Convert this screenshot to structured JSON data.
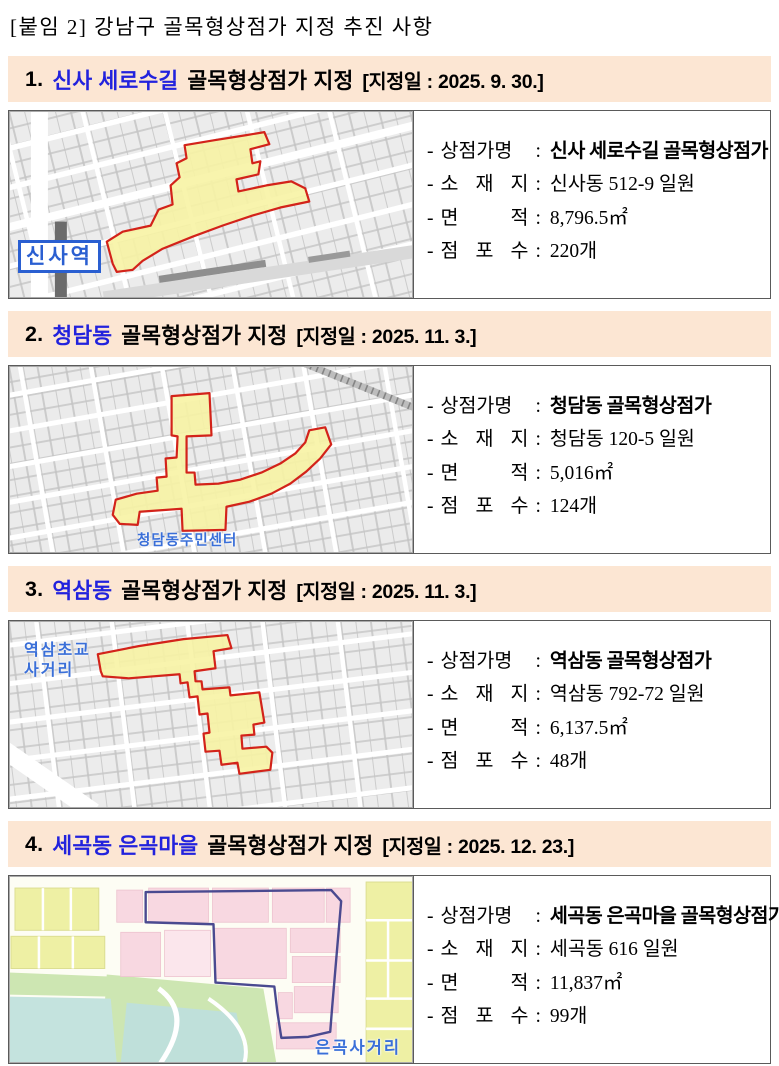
{
  "ui": {
    "dash": "-",
    "colon": ":"
  },
  "page": {
    "title": "[붙임 2] 강남구 골목형상점가 지정 추진 사항"
  },
  "colors": {
    "header_bg": "#fce6d3",
    "header_accent": "#2222dd",
    "highlight_fill": "#f7f3a4",
    "highlight_stroke": "#d3231a",
    "district_outline": "#4a4a90",
    "map_label_blue": "#2a5fd1"
  },
  "sections": [
    {
      "number": "1.",
      "name": "신사 세로수길",
      "title_rest": "골목형상점가 지정",
      "date": "[지정일 : 2025. 9. 30.]",
      "map_label": "신사역",
      "fields": [
        {
          "label": "상점가명",
          "value": "신사 세로수길 골목형상점가"
        },
        {
          "label": "소 재 지",
          "value": "신사동 512-9 일원"
        },
        {
          "label": "면 적",
          "value": "8,796.5㎡"
        },
        {
          "label": "점 포 수",
          "value": "220개"
        }
      ]
    },
    {
      "number": "2.",
      "name": "청담동",
      "title_rest": "골목형상점가 지정",
      "date": "[지정일 : 2025. 11. 3.]",
      "map_label": "청담동주민센터",
      "fields": [
        {
          "label": "상점가명",
          "value": "청담동 골목형상점가"
        },
        {
          "label": "소 재 지",
          "value": "청담동 120-5 일원"
        },
        {
          "label": "면 적",
          "value": "5,016㎡"
        },
        {
          "label": "점 포 수",
          "value": "124개"
        }
      ]
    },
    {
      "number": "3.",
      "name": "역삼동",
      "title_rest": "골목형상점가 지정",
      "date": "[지정일 : 2025. 11. 3.]",
      "map_label": "역삼초교 사거리",
      "fields": [
        {
          "label": "상점가명",
          "value": "역삼동 골목형상점가"
        },
        {
          "label": "소 재 지",
          "value": "역삼동 792-72 일원"
        },
        {
          "label": "면 적",
          "value": "6,137.5㎡"
        },
        {
          "label": "점 포 수",
          "value": "48개"
        }
      ]
    },
    {
      "number": "4.",
      "name": "세곡동 은곡마을",
      "title_rest": "골목형상점가 지정",
      "date": "[지정일 : 2025. 12. 23.]",
      "map_label": "은곡사거리",
      "fields": [
        {
          "label": "상점가명",
          "value": "세곡동 은곡마을 골목형상점가"
        },
        {
          "label": "소 재 지",
          "value": "세곡동 616 일원"
        },
        {
          "label": "면 적",
          "value": "11,837㎡"
        },
        {
          "label": "점 포 수",
          "value": "99개"
        }
      ]
    }
  ]
}
